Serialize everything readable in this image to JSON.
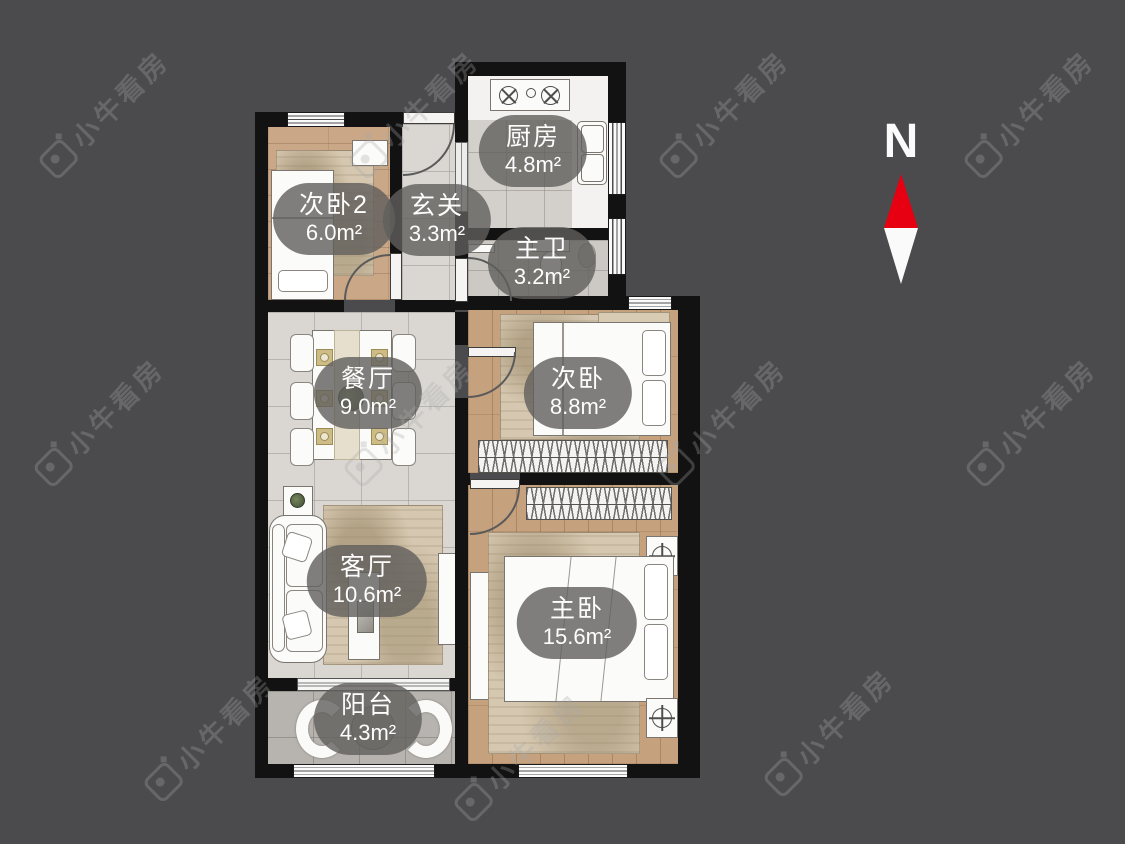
{
  "watermark": {
    "text": "小牛看房"
  },
  "compass": {
    "label": "N"
  },
  "colors": {
    "background": "#4b4a4c",
    "wall": "#121212",
    "compass_red": "#e60012",
    "label_pill": "rgba(96,95,92,0.8)"
  },
  "floorplan": {
    "rooms": [
      {
        "id": "bedroom2",
        "name": "次卧2",
        "area": "6.0m²"
      },
      {
        "id": "hallway",
        "name": "玄关",
        "area": "3.3m²"
      },
      {
        "id": "kitchen",
        "name": "厨房",
        "area": "4.8m²"
      },
      {
        "id": "master-bath",
        "name": "主卫",
        "area": "3.2m²"
      },
      {
        "id": "dining",
        "name": "餐厅",
        "area": "9.0m²"
      },
      {
        "id": "bedroom",
        "name": "次卧",
        "area": "8.8m²"
      },
      {
        "id": "living",
        "name": "客厅",
        "area": "10.6m²"
      },
      {
        "id": "master-bedroom",
        "name": "主卧",
        "area": "15.6m²"
      },
      {
        "id": "balcony",
        "name": "阳台",
        "area": "4.3m²"
      }
    ]
  }
}
